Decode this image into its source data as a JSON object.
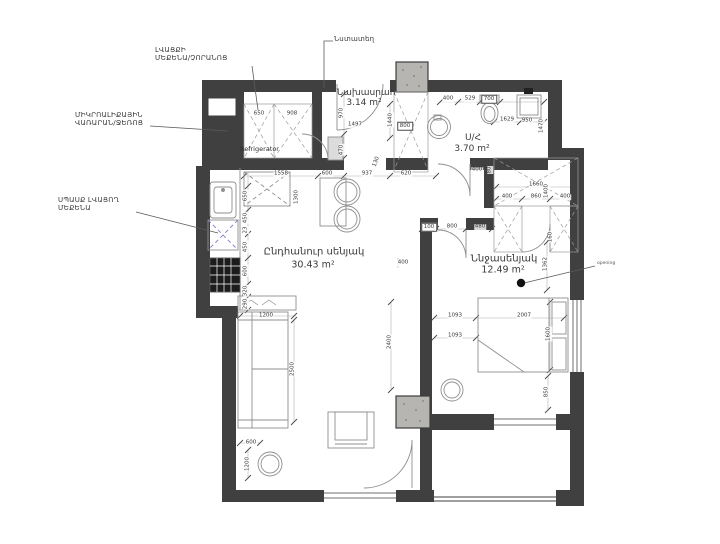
{
  "drawing": {
    "type": "apartment floor plan",
    "colors": {
      "wall": "#404040",
      "thin_line": "#8f8f8f",
      "dim_line": "#b0b0b0",
      "tick": "#4a4a4a",
      "column_fill": "#b7b5b2",
      "dishwasher_accent": "#7d7dcc",
      "text": "#3a3a3a"
    }
  },
  "rooms": {
    "hallway": {
      "name": "Նախասրահ",
      "area": "3.14 m²"
    },
    "bathroom": {
      "name": "Ս/Հ",
      "area": "3.70 m²"
    },
    "living": {
      "name": "Ընդհանուր սենյակ",
      "area": "30.43 m²"
    },
    "bedroom": {
      "name": "Ննջասենյակ",
      "area": "12.49 m²"
    }
  },
  "callouts": {
    "washer_dryer": {
      "line1": "ԼՎԱՑՔԻ",
      "line2": "ՄԵՔԵՆԱ/ՉՈՐԱՆՈՑ"
    },
    "microwave": {
      "line1": "ՄԻԿՐՈԱԼԻՔԱՅԻՆ",
      "line2": "ՎԱՌԱՐԱՆ/ՋԵՌՈՑ"
    },
    "dishwasher": {
      "line1": "ՍՊԱՍՔ ԼՎԱՑՈՂ",
      "line2": "ՄԵՔԵՆԱ"
    },
    "seat": {
      "label": "Նստատեղ"
    },
    "refrigerator": {
      "label": "Refrigerator"
    },
    "opening": {
      "label": "opening"
    }
  },
  "dimensions": [
    {
      "t": "650",
      "x": 259,
      "y": 114
    },
    {
      "t": "908",
      "x": 292,
      "y": 114
    },
    {
      "t": "970",
      "x": 342,
      "y": 113,
      "r": -90
    },
    {
      "t": "1497",
      "x": 355,
      "y": 125
    },
    {
      "t": "1440",
      "x": 391,
      "y": 120,
      "r": -90
    },
    {
      "t": "800",
      "x": 405,
      "y": 126,
      "box": true
    },
    {
      "t": "470",
      "x": 342,
      "y": 150,
      "r": -90
    },
    {
      "t": "130",
      "x": 377,
      "y": 162,
      "r": -70
    },
    {
      "t": "1558",
      "x": 281,
      "y": 174
    },
    {
      "t": "600",
      "x": 327,
      "y": 174
    },
    {
      "t": "937",
      "x": 367,
      "y": 174
    },
    {
      "t": "620",
      "x": 406,
      "y": 174
    },
    {
      "t": "650",
      "x": 246,
      "y": 196,
      "r": -90
    },
    {
      "t": "450",
      "x": 246,
      "y": 218,
      "r": -90
    },
    {
      "t": "23",
      "x": 246,
      "y": 230,
      "r": -90
    },
    {
      "t": "450",
      "x": 246,
      "y": 247,
      "r": -90
    },
    {
      "t": "600",
      "x": 246,
      "y": 271,
      "r": -90
    },
    {
      "t": "320",
      "x": 246,
      "y": 291,
      "r": -90
    },
    {
      "t": "290",
      "x": 246,
      "y": 304,
      "r": -90
    },
    {
      "t": "1300",
      "x": 297,
      "y": 197,
      "r": -90
    },
    {
      "t": "1200",
      "x": 266,
      "y": 316
    },
    {
      "t": "2500",
      "x": 293,
      "y": 369,
      "r": -90
    },
    {
      "t": "600",
      "x": 251,
      "y": 443
    },
    {
      "t": "1200",
      "x": 248,
      "y": 464,
      "r": -90
    },
    {
      "t": "2400",
      "x": 390,
      "y": 342,
      "r": -90
    },
    {
      "t": "400",
      "x": 403,
      "y": 263
    },
    {
      "t": "400",
      "x": 448,
      "y": 99
    },
    {
      "t": "529",
      "x": 470,
      "y": 99
    },
    {
      "t": "700",
      "x": 489,
      "y": 99,
      "box": true
    },
    {
      "t": "1629",
      "x": 507,
      "y": 120
    },
    {
      "t": "950",
      "x": 527,
      "y": 121
    },
    {
      "t": "1470",
      "x": 542,
      "y": 126,
      "r": -90
    },
    {
      "t": "400",
      "x": 477,
      "y": 170
    },
    {
      "t": "80",
      "x": 490,
      "y": 170,
      "r": -90
    },
    {
      "t": "1660",
      "x": 536,
      "y": 185
    },
    {
      "t": "400",
      "x": 507,
      "y": 197
    },
    {
      "t": "860",
      "x": 536,
      "y": 197
    },
    {
      "t": "400",
      "x": 565,
      "y": 197
    },
    {
      "t": "1400",
      "x": 547,
      "y": 191,
      "r": -90
    },
    {
      "t": "160",
      "x": 551,
      "y": 237,
      "r": -90
    },
    {
      "t": "100",
      "x": 429,
      "y": 227,
      "box": true
    },
    {
      "t": "800",
      "x": 452,
      "y": 227
    },
    {
      "t": "480",
      "x": 480,
      "y": 227
    },
    {
      "t": "1362",
      "x": 546,
      "y": 264,
      "r": -90
    },
    {
      "t": "1093",
      "x": 455,
      "y": 316
    },
    {
      "t": "1093",
      "x": 455,
      "y": 336
    },
    {
      "t": "2007",
      "x": 524,
      "y": 316
    },
    {
      "t": "1600",
      "x": 549,
      "y": 334,
      "r": -90
    },
    {
      "t": "850",
      "x": 547,
      "y": 392,
      "r": -90
    }
  ]
}
